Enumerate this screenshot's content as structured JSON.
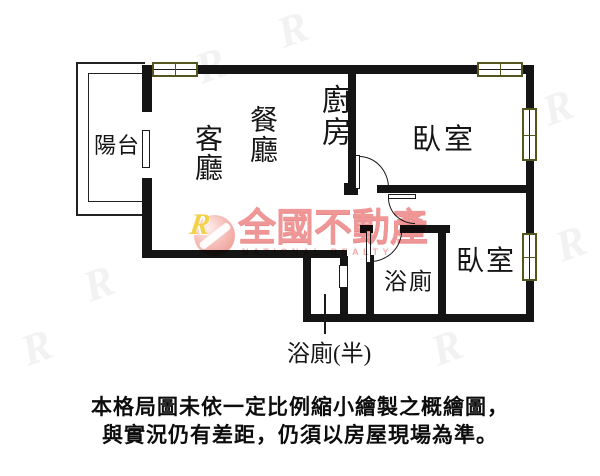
{
  "floor_plan": {
    "rooms": {
      "balcony": "陽台",
      "living_room": "客廳",
      "dining_room": "餐廳",
      "kitchen": "廚房",
      "bedroom_top": "臥室",
      "bedroom_bottom": "臥室",
      "bathroom": "浴廁",
      "half_bathroom": "浴廁(半)"
    }
  },
  "watermark": {
    "logo_letter": "R",
    "brand_zh": "全國不動產",
    "brand_en": "NATIONAL REALTY"
  },
  "caption": {
    "line1": "本格局圖未依一定比例縮小繪製之概繪圖，",
    "line2": "與實況仍有差距，仍須以房屋現場為準。"
  },
  "colors": {
    "wall": "#141414",
    "window_frame": "#55551f",
    "watermark_pink": "#ee8f8f",
    "watermark_yellow": "#f3cf3d"
  }
}
